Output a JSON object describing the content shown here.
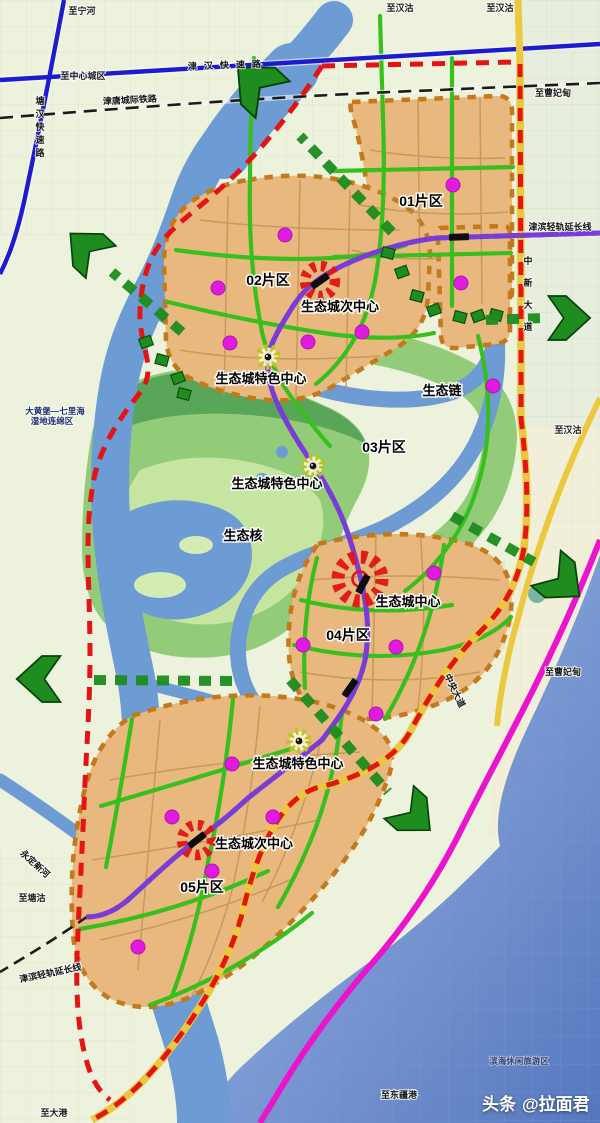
{
  "watermark": {
    "brand": "头条",
    "handle": "@拉面君"
  },
  "colors": {
    "land": "#edf2dd",
    "water": "#6d9bd4",
    "sea_light": "#b0c0e2",
    "sea_deep": "#5577be",
    "district_fill": "#e9b87f",
    "district_border": "#c4791c",
    "eco_green": "#92cc79",
    "eco_green_dark": "#4f9e55",
    "eco_green_light": "#c6e5a0",
    "corridor": "#38bf1d",
    "road_blue": "#1b1bd0",
    "road_red": "#e41414",
    "road_yellow": "#ecc83e",
    "road_magenta": "#ea14cc",
    "rail_purple": "#7a3cd6",
    "dot": "#e01ae0",
    "arrow": "#1e8c1e",
    "station": "#0d0d0d",
    "park": "#1f8c1f"
  },
  "labels": {
    "districts": [
      {
        "name": "label-district-01",
        "text": "01片区",
        "x": 421,
        "y": 206
      },
      {
        "name": "label-district-02",
        "text": "02片区",
        "x": 268,
        "y": 285
      },
      {
        "name": "label-district-03",
        "text": "03片区",
        "x": 384,
        "y": 452
      },
      {
        "name": "label-district-04",
        "text": "04片区",
        "x": 348,
        "y": 640
      },
      {
        "name": "label-district-05",
        "text": "05片区",
        "x": 202,
        "y": 892
      }
    ],
    "centers": [
      {
        "name": "label-subcenter-north",
        "text": "生态城次中心",
        "x": 340,
        "y": 311
      },
      {
        "name": "label-feature-center-north",
        "text": "生态城特色中心",
        "x": 261,
        "y": 383
      },
      {
        "name": "label-feature-center-mid",
        "text": "生态城特色中心",
        "x": 277,
        "y": 488
      },
      {
        "name": "label-city-center",
        "text": "生态城中心",
        "x": 408,
        "y": 606
      },
      {
        "name": "label-feature-center-south",
        "text": "生态城特色中心",
        "x": 298,
        "y": 768
      },
      {
        "name": "label-subcenter-south",
        "text": "生态城次中心",
        "x": 254,
        "y": 848
      }
    ],
    "eco": [
      {
        "name": "label-eco-chain",
        "text": "生态链",
        "x": 442,
        "y": 395
      },
      {
        "name": "label-eco-core",
        "text": "生态核",
        "x": 243,
        "y": 540
      }
    ],
    "roads": [
      {
        "name": "label-jinhan-expressway",
        "text": "津汉快速路",
        "x": 228,
        "y": 68,
        "rot": -2,
        "spacing": 7
      },
      {
        "name": "label-jintang-railway",
        "text": "津唐城际铁路",
        "x": 130,
        "y": 103,
        "rot": -3
      },
      {
        "name": "label-tanghan-expressway",
        "text": "塘汉快速路",
        "x": 40,
        "y": 104,
        "vertical": true,
        "dy": 13,
        "size": 8.5
      },
      {
        "name": "label-jinbin-lightrail-ext-ne",
        "text": "津滨轻轨延长线",
        "x": 560,
        "y": 230,
        "size": 8
      },
      {
        "name": "label-zhongxin-avenue",
        "text": "中新大道",
        "x": 528,
        "y": 264,
        "vertical": true,
        "dy": 22,
        "size": 9
      },
      {
        "name": "label-central-avenue",
        "text": "中央大道",
        "x": 452,
        "y": 692,
        "rot": 64,
        "size": 9
      },
      {
        "name": "label-jinbin-lightrail-ext-sw",
        "text": "津滨轻轨延长线",
        "x": 51,
        "y": 976,
        "rot": -12,
        "size": 8
      },
      {
        "name": "label-yongding-new-river",
        "text": "永定新河",
        "x": 33,
        "y": 866,
        "rot": 42,
        "size": 8
      }
    ],
    "destinations": [
      {
        "name": "label-to-ninghe",
        "text": "至宁河",
        "x": 82,
        "y": 14
      },
      {
        "name": "label-to-hangu-1",
        "text": "至汉沽",
        "x": 400,
        "y": 11
      },
      {
        "name": "label-to-hangu-2",
        "text": "至汉沽",
        "x": 500,
        "y": 11
      },
      {
        "name": "label-to-city-center",
        "text": "至中心城区",
        "x": 83,
        "y": 79
      },
      {
        "name": "label-to-caofeidian-n",
        "text": "至曹妃甸",
        "x": 553,
        "y": 96
      },
      {
        "name": "label-to-hangu-3",
        "text": "至汉沽",
        "x": 568,
        "y": 433
      },
      {
        "name": "label-to-caofeidian-s",
        "text": "至曹妃甸",
        "x": 563,
        "y": 675
      },
      {
        "name": "label-to-tanggu",
        "text": "至塘沽",
        "x": 32,
        "y": 901
      },
      {
        "name": "label-to-dagang",
        "text": "至大港",
        "x": 54,
        "y": 1116
      },
      {
        "name": "label-to-dongjiang-port",
        "text": "至东疆港",
        "x": 399,
        "y": 1098
      }
    ],
    "areas": [
      {
        "name": "label-wetland-1",
        "text": "大黄堡—七里海",
        "x": 55,
        "y": 414
      },
      {
        "name": "label-wetland-2",
        "text": "湿地连绵区",
        "x": 52,
        "y": 424
      },
      {
        "name": "label-binhai-leisure",
        "text": "滨海休闲旅游区",
        "x": 519,
        "y": 1064,
        "coast": true
      }
    ]
  },
  "markers": {
    "city_center": [
      {
        "x": 360,
        "y": 579,
        "r": 22
      }
    ],
    "sub_centers": [
      {
        "x": 320,
        "y": 281,
        "r": 15
      },
      {
        "x": 197,
        "y": 840,
        "r": 15
      }
    ],
    "feature_centers": [
      {
        "x": 268,
        "y": 357
      },
      {
        "x": 313,
        "y": 466
      },
      {
        "x": 299,
        "y": 741
      }
    ]
  },
  "stations": [
    {
      "x": 459,
      "y": 237,
      "rot": -2
    },
    {
      "x": 320,
      "y": 281,
      "rot": -35
    },
    {
      "x": 363,
      "y": 584,
      "rot": -62
    },
    {
      "x": 350,
      "y": 688,
      "rot": -55
    },
    {
      "x": 197,
      "y": 840,
      "rot": -38
    }
  ],
  "dots": [
    [
      453,
      185
    ],
    [
      461,
      283
    ],
    [
      493,
      386
    ],
    [
      285,
      235
    ],
    [
      218,
      288
    ],
    [
      230,
      343
    ],
    [
      308,
      342
    ],
    [
      362,
      332
    ],
    [
      434,
      573
    ],
    [
      303,
      645
    ],
    [
      396,
      647
    ],
    [
      376,
      714
    ],
    [
      232,
      764
    ],
    [
      172,
      817
    ],
    [
      273,
      817
    ],
    [
      212,
      871
    ],
    [
      138,
      947
    ]
  ],
  "parks": [
    [
      460,
      317
    ],
    [
      478,
      316
    ],
    [
      496,
      315
    ],
    [
      434,
      310
    ],
    [
      388,
      253
    ],
    [
      402,
      272
    ],
    [
      417,
      296
    ],
    [
      146,
      342
    ],
    [
      162,
      360
    ],
    [
      178,
      378
    ],
    [
      184,
      394
    ]
  ],
  "arrows": [
    {
      "x": 258,
      "y": 86,
      "angle": -137,
      "scale": 1.25,
      "tail": [
        392,
        232,
        300,
        136
      ]
    },
    {
      "x": 88,
      "y": 250,
      "angle": -137,
      "scale": 1.1,
      "tail": [
        182,
        332,
        112,
        272
      ]
    },
    {
      "x": 42,
      "y": 679,
      "angle": 180,
      "scale": 1.15,
      "tail": [
        232,
        681,
        92,
        680
      ]
    },
    {
      "x": 566,
      "y": 318,
      "angle": 0,
      "scale": 1.1,
      "tail": [
        486,
        320,
        542,
        318
      ]
    },
    {
      "x": 560,
      "y": 580,
      "angle": 40,
      "scale": 1.15,
      "tail": [
        452,
        516,
        534,
        562
      ]
    },
    {
      "x": 412,
      "y": 814,
      "angle": 42,
      "scale": 1.1,
      "tail": [
        290,
        680,
        388,
        792
      ]
    }
  ]
}
